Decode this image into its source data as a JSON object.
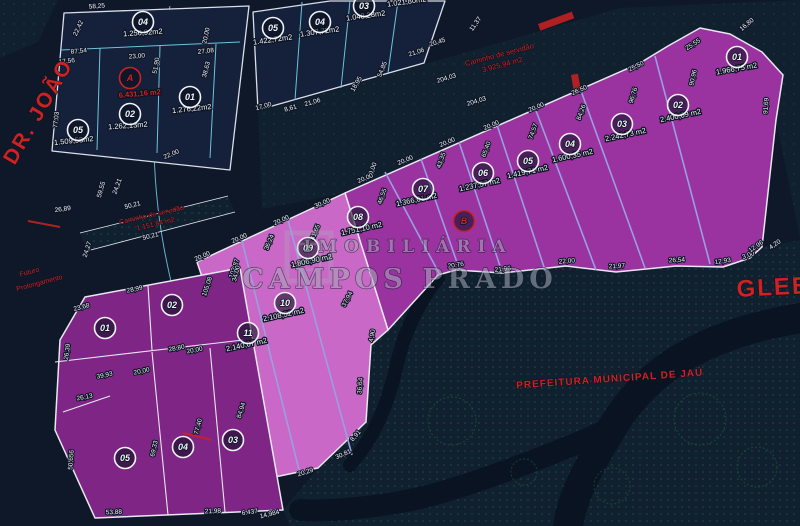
{
  "canvas": {
    "w": 800,
    "h": 526,
    "bg": "#0f1828"
  },
  "colors": {
    "quadra_fill": "#15203a",
    "quadra_stroke": "#d9dee9",
    "purple_fill": "#9a32a0",
    "pink_fill": "#c968c6",
    "q3_fill": "#7e2585",
    "outline": "#e8e8f0",
    "cyan": "#6fc3dc",
    "peri": "#99a0e0",
    "red": "#cc2222",
    "dim_text": "#f2f4f8",
    "halo": "#0c1424",
    "dots": "#2a6f62",
    "road": "#0a1322",
    "green": "#1e6b3d",
    "hatch_base": "#10202e",
    "watermark": "#a8aab8"
  },
  "hatches": [
    {
      "name": "hatch-prefeitura-area",
      "pts": "438,275 762,247 800,240 800,526 290,526 283,510 318,468 366,422 371,345 388,330",
      "sparse": false
    },
    {
      "name": "hatch-road-diagonal",
      "pts": "258,112 620,8 700,28 640,63 345,193 262,209",
      "sparse": true
    },
    {
      "name": "hatch-top-right",
      "pts": "620,8 800,0 800,238 776,120 783,75 762,52 730,34 700,28",
      "sparse": true
    },
    {
      "name": "hatch-top-left-corner",
      "pts": "0,0 58,0 38,42 0,58",
      "sparse": true
    },
    {
      "name": "hatch-servidao-strip",
      "pts": "80,233 228,196 235,212 87,251",
      "sparse": false
    }
  ],
  "roads": [
    {
      "name": "existing-road-1",
      "d": "M 800,318 C 700,335 645,372 612,428 C 585,472 572,498 568,526",
      "w": 30
    },
    {
      "name": "existing-road-2",
      "d": "M 612,428 C 560,452 470,486 420,498 C 380,507 330,512 300,510",
      "w": 22
    },
    {
      "name": "existing-road-3",
      "d": "M 438,278 C 420,300 405,330 398,360 C 390,395 380,430 350,465",
      "w": 14
    }
  ],
  "greens": [
    [
      452,
      421,
      24
    ],
    [
      700,
      419,
      26
    ],
    [
      757,
      467,
      20
    ],
    [
      612,
      486,
      18
    ],
    [
      524,
      472,
      13
    ]
  ],
  "parcels": [
    {
      "name": "quadra-1",
      "pts": "64,13 249,6 230,170 52,151",
      "fill": "quadra_fill",
      "stroke": "quadra_stroke",
      "w": 1.3
    },
    {
      "name": "quadra-2",
      "pts": "253,12 330,1 445,1 424,63 258,110",
      "fill": "quadra_fill",
      "stroke": "quadra_stroke",
      "w": 1.3
    },
    {
      "name": "gleba-purple-lots",
      "pts": "345,193 640,63 668,46 700,28 730,34 762,52 783,75 776,120 762,247 750,258 723,267 676,266 616,272 566,266 502,273 456,270 438,275 388,330",
      "fill": "purple_fill",
      "stroke": "outline",
      "w": 1.5
    },
    {
      "name": "gleba-pink-lots",
      "pts": "197,262 345,193 388,330 371,345 366,422 318,468 270,478",
      "fill": "pink_fill",
      "stroke": "outline",
      "w": 1.5
    },
    {
      "name": "quadra-3",
      "pts": "85,297 240,268 283,510 95,518 55,430 60,340",
      "fill": "q3_fill",
      "stroke": "outline",
      "w": 1.5
    }
  ],
  "lines": [
    {
      "name": "q1-div-h",
      "pts": "61,50 240,42",
      "c": "cyan",
      "w": 1
    },
    {
      "name": "q1-div-v1",
      "pts": "100,48 97,150",
      "c": "cyan",
      "w": 1
    },
    {
      "name": "q1-div-v2",
      "pts": "160,46 157,153",
      "c": "cyan",
      "w": 1
    },
    {
      "name": "q1-div-v3",
      "pts": "216,44 210,158",
      "c": "cyan",
      "w": 1
    },
    {
      "name": "q2-div-v1",
      "pts": "302,2 295,100",
      "c": "cyan",
      "w": 1
    },
    {
      "name": "q2-div-v2",
      "pts": "350,1 341,88",
      "c": "cyan",
      "w": 1
    },
    {
      "name": "q2-div-v3",
      "pts": "398,1 388,73",
      "c": "cyan",
      "w": 1
    },
    {
      "name": "purple-div-08-07",
      "pts": "385,172 440,275",
      "c": "peri",
      "w": 1.6
    },
    {
      "name": "purple-div-07-06",
      "pts": "421,159 460,271",
      "c": "peri",
      "w": 1.6
    },
    {
      "name": "purple-div-06-05",
      "pts": "459,142 502,272",
      "c": "peri",
      "w": 1.6
    },
    {
      "name": "purple-div-05-04",
      "pts": "497,125 545,270",
      "c": "peri",
      "w": 1.6
    },
    {
      "name": "purple-div-04-03",
      "pts": "535,108 596,270",
      "c": "peri",
      "w": 1.6
    },
    {
      "name": "purple-div-03-02",
      "pts": "580,88 645,268",
      "c": "peri",
      "w": 1.6
    },
    {
      "name": "purple-div-02-01",
      "pts": "655,56 710,264",
      "c": "peri",
      "w": 1.6
    },
    {
      "name": "pink-div-11-10",
      "pts": "242,241 300,474",
      "c": "peri",
      "w": 1.6
    },
    {
      "name": "pink-div-10-09",
      "pts": "288,220 352,455",
      "c": "peri",
      "w": 1.6
    },
    {
      "name": "q3-div-h1",
      "pts": "55,362 243,340",
      "c": "outline",
      "w": 1.1
    },
    {
      "name": "q3-div-h2",
      "pts": "63,412 110,396",
      "c": "outline",
      "w": 1.1
    },
    {
      "name": "q3-div-v1",
      "pts": "148,286 152,350",
      "c": "outline",
      "w": 1.1
    },
    {
      "name": "q3-div-v2",
      "pts": "152,352 168,515",
      "c": "outline",
      "w": 1.1
    },
    {
      "name": "q3-div-v3",
      "pts": "210,348 225,512",
      "c": "outline",
      "w": 1.1
    },
    {
      "name": "strip-edge-top",
      "pts": "80,233 228,196",
      "c": "outline",
      "w": 0.8
    },
    {
      "name": "strip-edge-bottom",
      "pts": "87,251 235,212",
      "c": "outline",
      "w": 0.8
    }
  ],
  "curves": [
    {
      "name": "street-curb-curve",
      "d": "M 170,6 C 152,80 148,160 164,248 C 176,312 198,382 216,432",
      "c": "cyan",
      "w": 1
    }
  ],
  "redmarks": {
    "rects": [
      [
        538,
        24,
        36,
        7,
        -20
      ],
      [
        571,
        75,
        7,
        17,
        -10
      ]
    ],
    "dashes": [
      [
        28,
        221,
        60,
        227
      ],
      [
        183,
        433,
        212,
        440
      ]
    ]
  },
  "measurements": [
    [
      "58,25",
      97,
      8,
      -4
    ],
    [
      "22,42",
      80,
      29,
      -65
    ],
    [
      "87,54",
      79,
      53,
      -6
    ],
    [
      "17,56",
      67,
      63,
      -6
    ],
    [
      "23,00",
      137,
      58,
      -4
    ],
    [
      "51,90",
      158,
      66,
      -80
    ],
    [
      "77,03",
      58,
      120,
      -84
    ],
    [
      "22,00",
      172,
      156,
      -22
    ],
    [
      "20,00",
      208,
      36,
      -78
    ],
    [
      "27,08",
      206,
      53,
      -6
    ],
    [
      "38,63",
      208,
      70,
      -75
    ],
    [
      "59,55",
      103,
      190,
      -74
    ],
    [
      "24,21",
      119,
      187,
      -70
    ],
    [
      "26,89",
      63,
      211,
      -8
    ],
    [
      "24,27",
      89,
      250,
      -72
    ],
    [
      "50,21",
      133,
      207,
      -14
    ],
    [
      "50,21",
      151,
      238,
      -14
    ],
    [
      "17,00",
      264,
      108,
      -16
    ],
    [
      "8,61",
      291,
      110,
      -16
    ],
    [
      "21,06",
      313,
      104,
      -16
    ],
    [
      "18,95",
      358,
      85,
      -60
    ],
    [
      "54,85",
      384,
      70,
      -68
    ],
    [
      "21,06",
      417,
      54,
      -18
    ],
    [
      "20,45",
      438,
      44,
      -18
    ],
    [
      "11,37",
      477,
      25,
      -55
    ],
    [
      "204,03",
      447,
      80,
      -17
    ],
    [
      "204,03",
      477,
      103,
      -17
    ],
    [
      "30,00",
      374,
      171,
      -70
    ],
    [
      "46,55",
      384,
      197,
      -70
    ],
    [
      "43,35",
      443,
      161,
      -70
    ],
    [
      "65,40",
      488,
      150,
      -70
    ],
    [
      "74,57",
      535,
      132,
      -70
    ],
    [
      "84,26",
      583,
      113,
      -70
    ],
    [
      "96,76",
      635,
      96,
      -73
    ],
    [
      "90,96",
      695,
      78,
      -78
    ],
    [
      "91,69",
      768,
      106,
      -86
    ],
    [
      "20,00",
      366,
      180,
      -23
    ],
    [
      "20,00",
      406,
      162,
      -23
    ],
    [
      "20,00",
      448,
      144,
      -23
    ],
    [
      "20,00",
      492,
      127,
      -23
    ],
    [
      "20,00",
      537,
      109,
      -23
    ],
    [
      "26,50",
      580,
      92,
      -24
    ],
    [
      "25,50",
      637,
      68,
      -26
    ],
    [
      "25,55",
      694,
      46,
      -33
    ],
    [
      "16,80",
      748,
      26,
      -40
    ],
    [
      "20,76",
      456,
      267,
      -8
    ],
    [
      "21,96",
      503,
      271,
      -6
    ],
    [
      "22,00",
      567,
      263,
      -5
    ],
    [
      "21,97",
      617,
      268,
      -3
    ],
    [
      "26,54",
      677,
      262,
      -3
    ],
    [
      "12,93",
      723,
      263,
      -8
    ],
    [
      "3,00",
      749,
      257,
      -20
    ],
    [
      "12,96",
      757,
      248,
      -35
    ],
    [
      "4,20",
      776,
      246,
      -35
    ],
    [
      "30,00",
      323,
      205,
      -24
    ],
    [
      "20,00",
      282,
      222,
      -24
    ],
    [
      "20,00",
      240,
      240,
      -24
    ],
    [
      "20,00",
      203,
      258,
      -24
    ],
    [
      "105,08",
      209,
      287,
      -72
    ],
    [
      "103,87",
      236,
      269,
      -72
    ],
    [
      "36,24",
      271,
      243,
      -68
    ],
    [
      "41,65",
      317,
      233,
      -68
    ],
    [
      "37,94",
      349,
      300,
      -62
    ],
    [
      "4,90",
      374,
      336,
      -80
    ],
    [
      "36,64",
      362,
      386,
      -86
    ],
    [
      "8,91",
      357,
      437,
      -48
    ],
    [
      "30,81",
      344,
      456,
      -24
    ],
    [
      "20,29",
      306,
      474,
      -18
    ],
    [
      "23,68",
      82,
      309,
      -14
    ],
    [
      "28,99",
      135,
      291,
      -12
    ],
    [
      "34,00",
      238,
      274,
      -76
    ],
    [
      "26,39",
      69,
      352,
      -82
    ],
    [
      "28,80",
      177,
      350,
      -11
    ],
    [
      "20,00",
      195,
      352,
      -11
    ],
    [
      "20,00",
      142,
      373,
      -12
    ],
    [
      "39,93",
      105,
      377,
      -12
    ],
    [
      "26,13",
      85,
      399,
      -11
    ],
    [
      "50,656",
      73,
      460,
      -86
    ],
    [
      "69,33",
      156,
      449,
      -78
    ],
    [
      "77,40",
      200,
      427,
      -76
    ],
    [
      "84,94",
      243,
      411,
      -72
    ],
    [
      "53,88",
      114,
      514,
      -3
    ],
    [
      "21,98",
      213,
      513,
      -3
    ],
    [
      "6.437",
      250,
      514,
      -8
    ],
    [
      "14,984",
      270,
      516,
      -14
    ]
  ],
  "areas": [
    [
      "1.256,92m2",
      143,
      35,
      -4,
      false
    ],
    [
      "6.431,16 m2",
      140,
      96,
      -5,
      true
    ],
    [
      "1.262,13m2",
      128,
      128,
      -4,
      false
    ],
    [
      "1.276,22m2",
      192,
      111,
      -6,
      false
    ],
    [
      "1.509,53m2",
      74,
      143,
      -6,
      false
    ],
    [
      "1.422,72m2",
      273,
      42,
      -8,
      false
    ],
    [
      "1.307,72m2",
      320,
      34,
      -8,
      false
    ],
    [
      "1.048,28m2",
      366,
      18,
      -8,
      false
    ],
    [
      "1.021,80m2",
      407,
      4,
      -8,
      false
    ],
    [
      "1.751,10 m2",
      362,
      231,
      -12,
      false
    ],
    [
      "1.366,01 m2",
      417,
      202,
      -12,
      false
    ],
    [
      "1.237,57 m2",
      480,
      187,
      -12,
      false
    ],
    [
      "1.419,71 m2",
      528,
      174,
      -12,
      false
    ],
    [
      "1.600,35 m2",
      573,
      158,
      -12,
      false
    ],
    [
      "2.242,73 m2",
      626,
      137,
      -12,
      false
    ],
    [
      "2.400,09 m2",
      681,
      118,
      -12,
      false
    ],
    [
      "1.966,75 m2",
      737,
      71,
      -10,
      false
    ],
    [
      "1.806,90 m2",
      312,
      263,
      -12,
      false
    ],
    [
      "2.108,52 m2",
      284,
      317,
      -12,
      false
    ],
    [
      "2.140,07 m2",
      247,
      347,
      -12,
      false
    ]
  ],
  "badges": [
    [
      "04",
      143,
      22,
      false
    ],
    [
      "A",
      130,
      78,
      true
    ],
    [
      "02",
      130,
      114,
      false
    ],
    [
      "01",
      190,
      97,
      false
    ],
    [
      "05",
      78,
      130,
      false
    ],
    [
      "05",
      273,
      28,
      false
    ],
    [
      "04",
      320,
      22,
      false
    ],
    [
      "03",
      364,
      6,
      false
    ],
    [
      "08",
      358,
      217,
      false
    ],
    [
      "07",
      423,
      189,
      false
    ],
    [
      "06",
      483,
      173,
      false
    ],
    [
      "05",
      528,
      161,
      false
    ],
    [
      "04",
      570,
      144,
      false
    ],
    [
      "03",
      622,
      124,
      false
    ],
    [
      "02",
      678,
      105,
      false
    ],
    [
      "01",
      737,
      57,
      false
    ],
    [
      "B",
      464,
      221,
      true
    ],
    [
      "09",
      308,
      248,
      false
    ],
    [
      "10",
      285,
      303,
      false
    ],
    [
      "11",
      248,
      333,
      false
    ],
    [
      "01",
      105,
      328,
      false
    ],
    [
      "02",
      172,
      305,
      false
    ],
    [
      "05",
      125,
      458,
      false
    ],
    [
      "04",
      183,
      447,
      false
    ],
    [
      "03",
      233,
      440,
      false
    ]
  ],
  "redtexts": [
    [
      "street-label-dr-joao",
      "DR. JOÃO",
      44,
      115,
      -60,
      21,
      700,
      2,
      "middle"
    ],
    [
      "annotation-futuro-line1",
      "Futuro",
      30,
      274,
      -15,
      7,
      400,
      0,
      "middle"
    ],
    [
      "annotation-futuro-line2",
      "Prolongamento",
      40,
      285,
      -15,
      7,
      400,
      0,
      "middle"
    ],
    [
      "road-servidao-label-line1",
      "Caminho de servidão",
      152,
      217,
      -13,
      7,
      400,
      0,
      "middle"
    ],
    [
      "road-servidao-label-line2",
      "1.151,84 m2",
      156,
      226,
      -13,
      7,
      400,
      0,
      "middle"
    ],
    [
      "road-diagonal-label-line1",
      "Caminho de servidão",
      500,
      57,
      -15,
      7.5,
      400,
      0,
      "middle"
    ],
    [
      "road-diagonal-label-line2",
      "3.925,94 m2",
      503,
      67,
      -15,
      7.5,
      400,
      0,
      "middle"
    ],
    [
      "label-prefeitura",
      "PREFEITURA MUNICIPAL DE JAÚ",
      610,
      382,
      -4,
      10,
      700,
      1,
      "middle"
    ],
    [
      "label-gleba-a",
      "GLEBA A",
      737,
      297,
      -3,
      24,
      700,
      2,
      "start"
    ]
  ],
  "watermark": {
    "logo": [
      287,
      233,
      44,
      48
    ],
    "inner": [
      298,
      244,
      22,
      26
    ],
    "texts": [
      [
        "IMOBILIÁRIA",
        408,
        252,
        17,
        7
      ],
      [
        "CAMPOS PRADO",
        400,
        288,
        27,
        5
      ]
    ]
  }
}
